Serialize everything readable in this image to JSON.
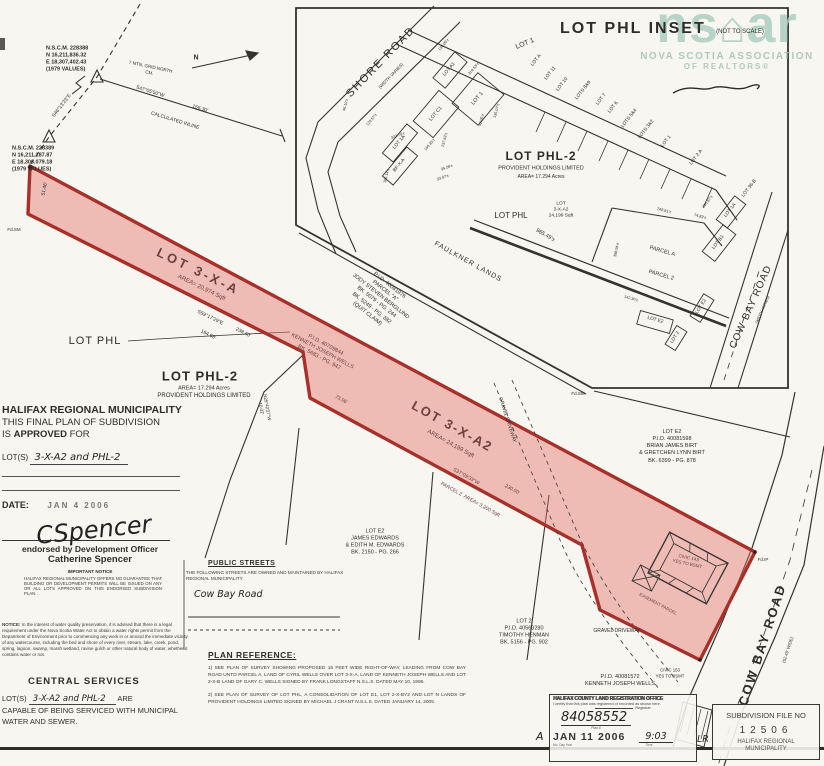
{
  "watermark": {
    "logo_left": "ns",
    "logo_roof": "⌂",
    "logo_right": "ar",
    "line1": "NOVA SCOTIA ASSOCIATION",
    "line2": "OF REALTORS®"
  },
  "inset": {
    "title": "LOT PHL INSET",
    "subtitle": "(NOT TO SCALE)"
  },
  "approval": {
    "line1": "HALIFAX REGIONAL MUNICIPALITY",
    "line2": "THIS FINAL PLAN OF SUBDIVISION",
    "line3_pre": "IS ",
    "line3_bold": "APPROVED",
    "line3_post": " FOR",
    "lots_prefix": "LOT(S)",
    "lots_handwritten": "3-X-A2 and PHL-2",
    "date_label": "DATE:",
    "date_stamp": "JAN  4  2006"
  },
  "signature": {
    "script": "CSpencer",
    "line1": "endorsed by Development Officer",
    "line2": "Catherine Spencer",
    "notice_title": "IMPORTANT NOTICE",
    "notice_body": "HALIFAX REGIONAL MUNICIPALITY OFFERS NO GUARANTEE THAT BUILDING OR DEVELOPMENT PERMITS WILL BE ISSUED ON ANY OR ALL LOTS APPROVED ON THIS ENDORSED SUBDIVISION PLAN."
  },
  "water_notice": {
    "prefix": "NOTICE:",
    "body": " In the interest of water quality preservation, it is advised that there is a legal requirement under the Nova Scotia Water Act to obtain a water rights permit from the Department of Environment prior to commencing any work in or around the immediate vicinity of any watercourse, including the bed and shore of every river, stream, lake, creek, pond, spring, lagoon, swamp, marsh wetland, ravine gulch or other natural body of water, whether it contains water or not."
  },
  "central_services": {
    "title": "CENTRAL SERVICES",
    "lots_prefix": "LOT(S)",
    "lots_handwritten": "3-X-A2 and PHL-2",
    "suffix": "ARE",
    "body": "CAPABLE OF BEING SERVICED WITH MUNICIPAL WATER AND SEWER."
  },
  "public_streets": {
    "title": "PUBLIC STREETS",
    "body": "THE FOLLOWING STREETS ARE OWNED AND MAINTAINED BY HALIFAX REGIONAL MUNICIPALITY",
    "street_handwritten": "Cow Bay Road"
  },
  "plan_reference": {
    "title": "PLAN REFERENCE:",
    "item1": "1) SEE PLAN OF SURVEY SHOWING PROPOSED 15 FEET WIDE RIGHT-OF-WAY, LEADING FROM COW BAY ROAD UNTO PARCEL A, LAND OF CYRIL WELLS OVER LOT 3-X-A, LAND OF KENNETH JOSEPH WELLS AND LOT 2-X-B LAND OF GARY C. WELLS SIGNED BY FRANK LONGSTAFF N.S.L.S. DATED MAY 10, 1995.",
    "item2": "2) SEE PLAN OF SURVEY OF LOT PHL, A CONSOLIDATION OF LOT E1, LOT 2-X-BY2 AND LOT N LANDS OF PROVIDENT HOLDINGS LIMITED SIGNED BY MICHAEL J CRANT N.S.L.S. DATED JANUARY 14, 2005"
  },
  "registration_stamp": {
    "office": "HALIFAX COUNTY LAND REGISTRATION OFFICE",
    "certify": "I certify that this plan was registered or recorded as shown here.",
    "registrar_label": ", Registrar",
    "plan_number": "84058552",
    "plan_number_label": "Plan #",
    "date_stamp": "JAN 11 2006",
    "date_caption": "Mo.  Day  Year",
    "time_handwritten": "9:03",
    "time_caption": "Time",
    "margin_left": "A",
    "margin_right": "LR"
  },
  "subdivision_box": {
    "title": "SUBDIVISION FILE NO",
    "number": "12506",
    "footer1": "HALIFAX REGIONAL",
    "footer2": "MUNICIPALITY"
  },
  "plan_labels": [
    {
      "t": "N.S.C.M. 228388\nN 16,211,836.32\nE 18,307,402.43\n(1979 VALUES)",
      "x": 46,
      "y": 60,
      "s": 5.5,
      "al": "l",
      "b": 1
    },
    {
      "t": "N.S.C.M. 228389\nN 16,211,187.87\nE 18,306,079.18\n(1979 VALUES)",
      "x": 12,
      "y": 160,
      "s": 5.5,
      "al": "l",
      "b": 1
    },
    {
      "t": "7 MTN. GRID NORTH\nCM.",
      "x": 150,
      "y": 70,
      "s": 4.5,
      "r": 12
    },
    {
      "t": "N",
      "x": 196,
      "y": 58,
      "s": 7,
      "b": 1
    },
    {
      "t": "S47°05'50\"W",
      "x": 150,
      "y": 92,
      "s": 5,
      "r": 17
    },
    {
      "t": "156.30'",
      "x": 200,
      "y": 109,
      "s": 5,
      "r": 17
    },
    {
      "t": "CALCULATED INLINE",
      "x": 175,
      "y": 121,
      "s": 5,
      "r": 17
    },
    {
      "t": "S46°13'23\"E",
      "x": 62,
      "y": 106,
      "s": 5,
      "r": -52
    },
    {
      "t": "51.46'",
      "x": 45,
      "y": 189,
      "s": 5,
      "r": -78
    },
    {
      "t": "Fd.SM",
      "x": 14,
      "y": 230,
      "s": 4.5
    },
    {
      "t": "LOT 3-X-A",
      "x": 198,
      "y": 272,
      "s": 13,
      "r": 26,
      "b": 1,
      "c": "p",
      "ls": 3
    },
    {
      "t": "AREA= 20,974 Sqft",
      "x": 201,
      "y": 289,
      "s": 6,
      "r": 26,
      "c": "p"
    },
    {
      "t": "LOT PHL",
      "x": 95,
      "y": 341,
      "s": 11,
      "ls": 1
    },
    {
      "t": "S59°17'29\"E",
      "x": 210,
      "y": 318,
      "s": 5,
      "r": 26
    },
    {
      "t": "164.68'",
      "x": 208,
      "y": 335,
      "s": 5,
      "r": 26
    },
    {
      "t": "238.40'",
      "x": 243,
      "y": 333,
      "s": 5,
      "r": 26
    },
    {
      "t": "LOT PHL-2",
      "x": 200,
      "y": 377,
      "s": 13,
      "b": 1,
      "ls": 1
    },
    {
      "t": "AREA= 17.294 Acres",
      "x": 204,
      "y": 389,
      "s": 5.5
    },
    {
      "t": "PROVIDENT HOLDINGS LIMITED",
      "x": 204,
      "y": 397,
      "s": 6
    },
    {
      "t": "N25°42'27\"W\n10.02'",
      "x": 264,
      "y": 408,
      "s": 4.5,
      "r": 80
    },
    {
      "t": "P.I.D. 40081976\nPARCEL \"A\"\nJODY STEVEN BERGLUND\nBK. 5079 - PG. 244\nBK. 5249 - PG. 382\n(QUIT CLAIM)",
      "x": 378,
      "y": 300,
      "s": 5.5,
      "r": 38
    },
    {
      "t": "P.I.D. 40709844\nKENNETH JOSEPH WELLS\nBK. 5683 - PG. 947",
      "x": 322,
      "y": 352,
      "s": 5.5,
      "r": 28,
      "c": "p"
    },
    {
      "t": "FAULKNER LANDS",
      "x": 468,
      "y": 262,
      "s": 7,
      "r": 29,
      "ls": 1
    },
    {
      "t": "965.49'±",
      "x": 545,
      "y": 236,
      "s": 5.5,
      "r": 29
    },
    {
      "t": "73.06'",
      "x": 341,
      "y": 400,
      "s": 5,
      "r": 28,
      "c": "p"
    },
    {
      "t": "LOT 3-X-A2",
      "x": 452,
      "y": 427,
      "s": 13,
      "r": 29,
      "b": 1,
      "c": "p",
      "ls": 2
    },
    {
      "t": "AREA= 24,199 Sqft",
      "x": 450,
      "y": 445,
      "s": 6,
      "r": 29,
      "c": "p"
    },
    {
      "t": "S37°09'33\"W",
      "x": 466,
      "y": 477,
      "s": 5,
      "r": 29,
      "c": "p"
    },
    {
      "t": "230.00'",
      "x": 512,
      "y": 490,
      "s": 5,
      "r": 29,
      "c": "p"
    },
    {
      "t": "PARCEL 2  AREA= 3,200 Sqft",
      "x": 470,
      "y": 500,
      "s": 5,
      "r": 29,
      "c": "p"
    },
    {
      "t": "GRAVEL DRIVEWAY",
      "x": 507,
      "y": 420,
      "s": 5,
      "r": 72
    },
    {
      "t": "LOT E2\nP.I.D. 40081598\nBRIAN JAMES BIRT\n& GRETCHEN LYNN BIRT\nBK. 6399 - PG. 878",
      "x": 672,
      "y": 447,
      "s": 5.5
    },
    {
      "t": "LOT E2\nJAMES EDWARDS\n& EDITH M. EDWARDS\nBK. 2150 - PG. 266",
      "x": 375,
      "y": 543,
      "s": 5.5
    },
    {
      "t": "LOT 2\nP.I.D. 40563280\nTIMOTHY HENMAN\nBK. 5156 - PG. 902",
      "x": 524,
      "y": 633,
      "s": 5.5
    },
    {
      "t": "GRAVEL DRIVEWAY",
      "x": 617,
      "y": 631,
      "s": 5
    },
    {
      "t": "P.I.D. 40081572\nKENNETH JOSEPH WELLS",
      "x": 620,
      "y": 681,
      "s": 5.5
    },
    {
      "t": "CIVIC 153\nYES TO BSMT",
      "x": 670,
      "y": 673,
      "s": 4.3
    },
    {
      "t": "CIVIC 143\nYES TO BSMT",
      "x": 688,
      "y": 561,
      "s": 4.5,
      "r": 12,
      "c": "p"
    },
    {
      "t": "EASEMENT PARCEL",
      "x": 658,
      "y": 604,
      "s": 4.3,
      "r": 28,
      "c": "p"
    },
    {
      "t": "Fd.IP",
      "x": 763,
      "y": 560,
      "s": 4.5
    },
    {
      "t": "Fd.SM",
      "x": 578,
      "y": 394,
      "s": 4.5
    },
    {
      "t": "COW BAY ROAD",
      "x": 763,
      "y": 645,
      "s": 13,
      "r": -72,
      "ls": 2,
      "b": 1
    },
    {
      "t": "(52.49' WIDE)",
      "x": 788,
      "y": 650,
      "s": 4.3,
      "r": -72
    },
    {
      "t": "SHORE ROAD",
      "x": 381,
      "y": 62,
      "s": 11,
      "r": -46,
      "ls": 2
    },
    {
      "t": "(WIDTH VARIES)",
      "x": 391,
      "y": 76,
      "s": 4.3,
      "r": -46
    },
    {
      "t": "LOT 1",
      "x": 525,
      "y": 44,
      "s": 7,
      "r": -22
    },
    {
      "t": "LOT A",
      "x": 537,
      "y": 61,
      "s": 4.8,
      "r": -52
    },
    {
      "t": "LOT 11",
      "x": 551,
      "y": 74,
      "s": 4.8,
      "r": -52
    },
    {
      "t": "LOT 10",
      "x": 563,
      "y": 85,
      "s": 4.8,
      "r": -52
    },
    {
      "t": "LOTS 8&9",
      "x": 584,
      "y": 91,
      "s": 4.8,
      "r": -52
    },
    {
      "t": "LOT 7",
      "x": 602,
      "y": 100,
      "s": 4.8,
      "r": -52
    },
    {
      "t": "LOT 6",
      "x": 614,
      "y": 108,
      "s": 4.8,
      "r": -52
    },
    {
      "t": "LOTS 5&4",
      "x": 630,
      "y": 119,
      "s": 4.8,
      "r": -52
    },
    {
      "t": "LOTS 3&2",
      "x": 647,
      "y": 130,
      "s": 4.8,
      "r": -52
    },
    {
      "t": "LOT 1",
      "x": 667,
      "y": 142,
      "s": 4.8,
      "r": -52
    },
    {
      "t": "LOT 2-A",
      "x": 697,
      "y": 158,
      "s": 4.8,
      "r": -52
    },
    {
      "t": "LOT 36-B",
      "x": 750,
      "y": 189,
      "s": 4.8,
      "r": -52
    },
    {
      "t": "LOT A1",
      "x": 450,
      "y": 70,
      "s": 4.8,
      "r": -50
    },
    {
      "t": "LOT 1",
      "x": 478,
      "y": 99,
      "s": 5.5,
      "r": -50
    },
    {
      "t": "LOT C1",
      "x": 436,
      "y": 114,
      "s": 5,
      "r": -50
    },
    {
      "t": "LOT 1A",
      "x": 400,
      "y": 143,
      "s": 4.8,
      "r": -50
    },
    {
      "t": "BF-X-A",
      "x": 400,
      "y": 166,
      "s": 4.8,
      "r": -50
    },
    {
      "t": "139.00'±",
      "x": 444,
      "y": 45,
      "s": 3.8,
      "r": -50
    },
    {
      "t": "319.53'±",
      "x": 474,
      "y": 69,
      "s": 3.8,
      "r": -50
    },
    {
      "t": "46.10'±",
      "x": 346,
      "y": 105,
      "s": 3.8,
      "r": -75
    },
    {
      "t": "120.67'±",
      "x": 372,
      "y": 120,
      "s": 3.8,
      "r": -50
    },
    {
      "t": "322.70'±",
      "x": 398,
      "y": 136,
      "s": 3.8,
      "r": -20
    },
    {
      "t": "166.35'±",
      "x": 430,
      "y": 145,
      "s": 3.8,
      "r": -50
    },
    {
      "t": "237.83'±",
      "x": 445,
      "y": 140,
      "s": 3.8,
      "r": -75
    },
    {
      "t": "42.05'±",
      "x": 482,
      "y": 120,
      "s": 3.8,
      "r": -75
    },
    {
      "t": "135.07'±",
      "x": 497,
      "y": 111,
      "s": 3.8,
      "r": -75
    },
    {
      "t": "35.28'±",
      "x": 447,
      "y": 168,
      "s": 3.8,
      "r": -20
    },
    {
      "t": "33.97'±",
      "x": 443,
      "y": 178,
      "s": 3.8,
      "r": -20
    },
    {
      "t": "166.14'±",
      "x": 387,
      "y": 176,
      "s": 3.8,
      "r": -75
    },
    {
      "t": "LOT PHL-2",
      "x": 541,
      "y": 157,
      "s": 12,
      "b": 1,
      "ls": 1
    },
    {
      "t": "PROVIDENT HOLDINGS LIMITED",
      "x": 541,
      "y": 169,
      "s": 5.5
    },
    {
      "t": "AREA= 17.294 Acres",
      "x": 541,
      "y": 177,
      "s": 5
    },
    {
      "t": "LOT\n3-X-A2\n24,199 Sqft",
      "x": 561,
      "y": 211,
      "s": 4.8
    },
    {
      "t": "LOT PHL",
      "x": 511,
      "y": 216,
      "s": 8
    },
    {
      "t": "155.87'±",
      "x": 708,
      "y": 202,
      "s": 3.8,
      "r": -52
    },
    {
      "t": "LOT 1A",
      "x": 731,
      "y": 211,
      "s": 4.8,
      "r": -52
    },
    {
      "t": "LOT B1",
      "x": 719,
      "y": 243,
      "s": 4.8,
      "r": -52
    },
    {
      "t": "248.81'±",
      "x": 664,
      "y": 211,
      "s": 3.8,
      "r": 14
    },
    {
      "t": "74.83'±",
      "x": 700,
      "y": 217,
      "s": 3.8,
      "r": 14
    },
    {
      "t": "398.94'±",
      "x": 617,
      "y": 250,
      "s": 3.8,
      "r": -78
    },
    {
      "t": "PARCEL A",
      "x": 662,
      "y": 252,
      "s": 5.5,
      "r": 16
    },
    {
      "t": "PARCEL 2",
      "x": 661,
      "y": 276,
      "s": 5.5,
      "r": 16
    },
    {
      "t": "LOT E2",
      "x": 702,
      "y": 307,
      "s": 4.8,
      "r": -58
    },
    {
      "t": "LOT E2",
      "x": 655,
      "y": 321,
      "s": 4.8,
      "r": 16
    },
    {
      "t": "LOT 2",
      "x": 676,
      "y": 338,
      "s": 4.8,
      "r": -58
    },
    {
      "t": "142.30'±",
      "x": 631,
      "y": 299,
      "s": 3.8,
      "r": 16
    },
    {
      "t": "COW BAY ROAD",
      "x": 751,
      "y": 307,
      "s": 10,
      "r": -66,
      "ls": 1
    },
    {
      "t": "(WIDTH VARIES)",
      "x": 763,
      "y": 310,
      "s": 3.8,
      "r": -66
    }
  ]
}
